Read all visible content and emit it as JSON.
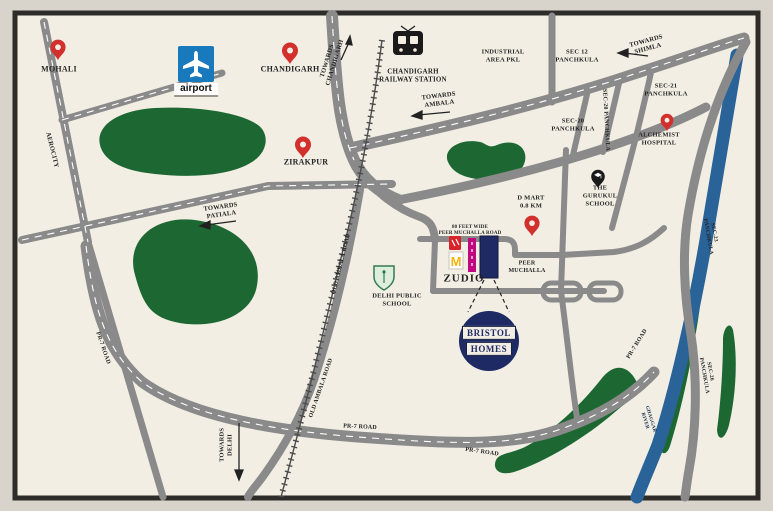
{
  "colors": {
    "map_background": "#f2eee4",
    "frame": "#2e2c28",
    "road": "#8a8a8a",
    "green_area": "#1d6832",
    "river": "#2a6398",
    "pin_red": "#d2302c",
    "pin_black": "#1a1a1a",
    "brand_navy": "#1e2a63",
    "zudio_magenta": "#c0087f",
    "mcdonalds_yellow": "#f6b50f",
    "airport_blue": "#1879bd"
  },
  "places": {
    "mohali": "MOHALI",
    "chandigarh": "CHANDIGARH",
    "zirakpur": "ZIRAKPUR",
    "airport": "airport",
    "railway_station": "CHANDIGARH RAILWAY STATION",
    "industrial_area": "INDUSTRIAL AREA PKL",
    "sec_12": "SEC 12 PANCHKULA",
    "sec_20": "SEC-20 PANCHKULA",
    "sec_21": "SEC-21 PANCHKULA",
    "sec_23": "SEC-23 PANCHKULA",
    "sec_26": "SEC-26 PANCHKULA",
    "alchemist_hospital": "ALCHEMIST HOSPITAL",
    "gurukul_school": "THE GURUKUL SCHOOL",
    "d_mart": "D MART 0.8 KM",
    "delhi_public_school": "DELHI PUBLIC SCHOOL",
    "zudio": "ZUDIO",
    "peer_muchalla": "PEER MUCHALLA",
    "ghaggar_river": "GHAGGAR RIVER"
  },
  "directions": {
    "towards_chandigarh": "TOWARDS CHANDIGARH",
    "towards_ambala": "TOWARDS AMBALA",
    "towards_shimla": "TOWARDS SHIMLA",
    "towards_patiala": "TOWARDS PATIALA",
    "towards_delhi": "TOWARDS DELHI"
  },
  "road_labels": {
    "aerocity": "AEROCITY",
    "old_ambala_road": "OLD AMBALA ROAD",
    "pr7_road": "PR-7 ROAD",
    "peer_muchalla_road_line1": "80 FEET WIDE",
    "peer_muchalla_road_line2": "PEER MUCHALLA ROAD"
  },
  "project": {
    "name_line1": "BRISTOL",
    "name_line2": "HOMES"
  }
}
